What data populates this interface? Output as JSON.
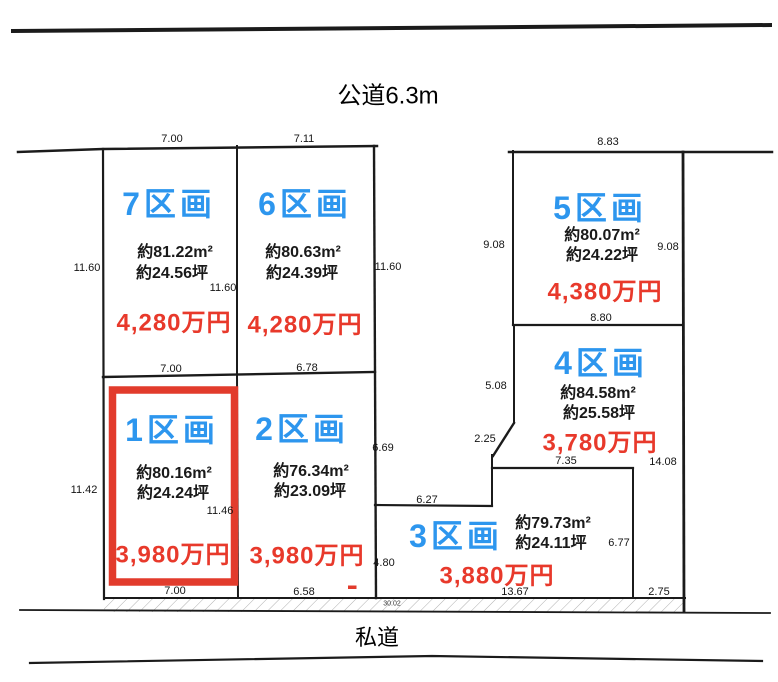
{
  "roads": {
    "top_road": "公道6.3m",
    "bottom_road": "私道"
  },
  "plots": {
    "p1": {
      "label": "1区画",
      "area": "約80.16m²",
      "tsubo": "約24.24坪",
      "price": "3,980万円",
      "highlighted": true
    },
    "p2": {
      "label": "2区画",
      "area": "約76.34m²",
      "tsubo": "約23.09坪",
      "price": "3,980万円",
      "highlighted": false
    },
    "p3": {
      "label": "3区画",
      "area": "約79.73m²",
      "tsubo": "約24.11坪",
      "price": "3,880万円",
      "highlighted": false
    },
    "p4": {
      "label": "4区画",
      "area": "約84.58m²",
      "tsubo": "約25.58坪",
      "price": "3,780万円",
      "highlighted": false
    },
    "p5": {
      "label": "5区画",
      "area": "約80.07m²",
      "tsubo": "約24.22坪",
      "price": "4,380万円",
      "highlighted": false
    },
    "p6": {
      "label": "6区画",
      "area": "約80.63m²",
      "tsubo": "約24.39坪",
      "price": "4,280万円",
      "highlighted": false
    },
    "p7": {
      "label": "7区画",
      "area": "約81.22m²",
      "tsubo": "約24.56坪",
      "price": "4,280万円",
      "highlighted": false
    }
  },
  "dims": {
    "plot7_top": "7.00",
    "plot6_top": "7.11",
    "plot5_top": "8.83",
    "left_upper": "11.60",
    "plot7_inner": "11.60",
    "plot6_right": "11.60",
    "plot5_left": "9.08",
    "plot5_right": "9.08",
    "plot5_bottom": "8.80",
    "plot4_left": "5.08",
    "plot4_diag": "2.25",
    "plot4_bottom": "7.35",
    "plot4_right": "14.08",
    "plot2_right_upper": "6.69",
    "plot2_right_lower": "4.80",
    "plot3_step": "6.27",
    "plot3_right": "6.77",
    "plot3_bottom": "13.67",
    "plot3_pole": "2.75",
    "boundary_7_1": "7.00",
    "plot6_bottom": "6.78",
    "plot1_inner": "11.46",
    "plot1_bottom": "7.00",
    "plot2_bottom": "6.58",
    "left_lower": "11.42",
    "road_strip": "30.02"
  },
  "colors": {
    "plot_label_blue": "#2d96ee",
    "price_red": "#e8392b",
    "highlight_border_red": "#e23b2c",
    "boundary_line": "#1b1b1b"
  }
}
